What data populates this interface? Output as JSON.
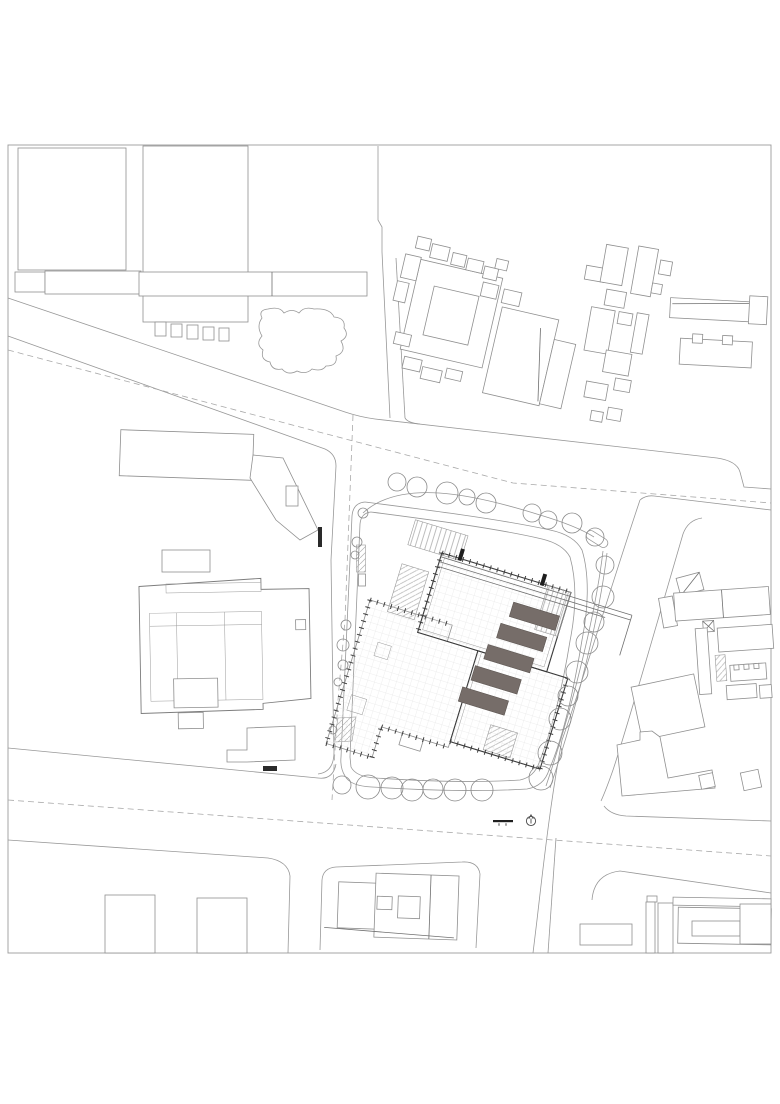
{
  "meta": {
    "document_type": "architectural-site-plan",
    "background": "#ffffff",
    "frame": {
      "x": 8,
      "y": 145,
      "width": 763,
      "height": 808,
      "stroke": "#9b9b9b"
    }
  },
  "palette": {
    "linework_light": "#989898",
    "linework_medium": "#6f6f6f",
    "linework_dark": "#3a3a3a",
    "skylight_fill": "#766d69",
    "hatch_fill": "#ececec",
    "grid_line": "#dedede",
    "dashed_line": "#a9a9a9",
    "tree_stroke": "#8a8a8a",
    "black_accent": "#1e1e1e"
  },
  "symbols": {
    "north_arrow": {
      "name": "north-arrow-icon",
      "cx": 531,
      "cy": 821,
      "r": 4.6,
      "stroke": "#4a4a4a"
    },
    "scale_bar": {
      "name": "scale-bar",
      "x": 493,
      "y": 820,
      "width": 20,
      "height": 2.2,
      "fill": "#1e1e1e",
      "tick_xs": [
        499,
        506
      ]
    }
  },
  "site": {
    "central_building": {
      "rotation_deg": 17,
      "pivot": [
        370,
        600
      ],
      "skylights": [
        {
          "x": 138,
          "y": -40,
          "w": 48,
          "h": 15
        },
        {
          "x": 132,
          "y": -16,
          "w": 48,
          "h": 15
        },
        {
          "x": 126,
          "y": 8,
          "w": 48,
          "h": 15
        },
        {
          "x": 120,
          "y": 32,
          "w": 48,
          "h": 15
        },
        {
          "x": 114,
          "y": 56,
          "w": 48,
          "h": 15
        }
      ],
      "entry_marks": [
        {
          "x": 72,
          "y": -76
        },
        {
          "x": 158,
          "y": -76
        }
      ]
    },
    "trees": {
      "top": [
        [
          397,
          482,
          9
        ],
        [
          417,
          487,
          10
        ],
        [
          447,
          493,
          11
        ],
        [
          467,
          497,
          8
        ],
        [
          486,
          503,
          10
        ],
        [
          532,
          513,
          9
        ],
        [
          548,
          520,
          9
        ],
        [
          572,
          523,
          10
        ],
        [
          595,
          537,
          9
        ]
      ],
      "right": [
        [
          605,
          565,
          9
        ],
        [
          603,
          597,
          11
        ],
        [
          594,
          622,
          10
        ],
        [
          587,
          643,
          11
        ],
        [
          577,
          672,
          11
        ],
        [
          568,
          696,
          10
        ],
        [
          560,
          719,
          11
        ],
        [
          550,
          753,
          12
        ],
        [
          541,
          778,
          12
        ]
      ],
      "bottom": [
        [
          482,
          790,
          11
        ],
        [
          455,
          790,
          11
        ],
        [
          433,
          789,
          10
        ],
        [
          412,
          790,
          11
        ],
        [
          392,
          788,
          11
        ],
        [
          368,
          787,
          12
        ],
        [
          342,
          785,
          9
        ]
      ],
      "left": [
        [
          333,
          730,
          4
        ],
        [
          338,
          682,
          4
        ],
        [
          343,
          665,
          5
        ],
        [
          343,
          645,
          6
        ],
        [
          346,
          625,
          5
        ],
        [
          355,
          555,
          4
        ],
        [
          357,
          542,
          5
        ],
        [
          363,
          513,
          5
        ]
      ]
    }
  }
}
